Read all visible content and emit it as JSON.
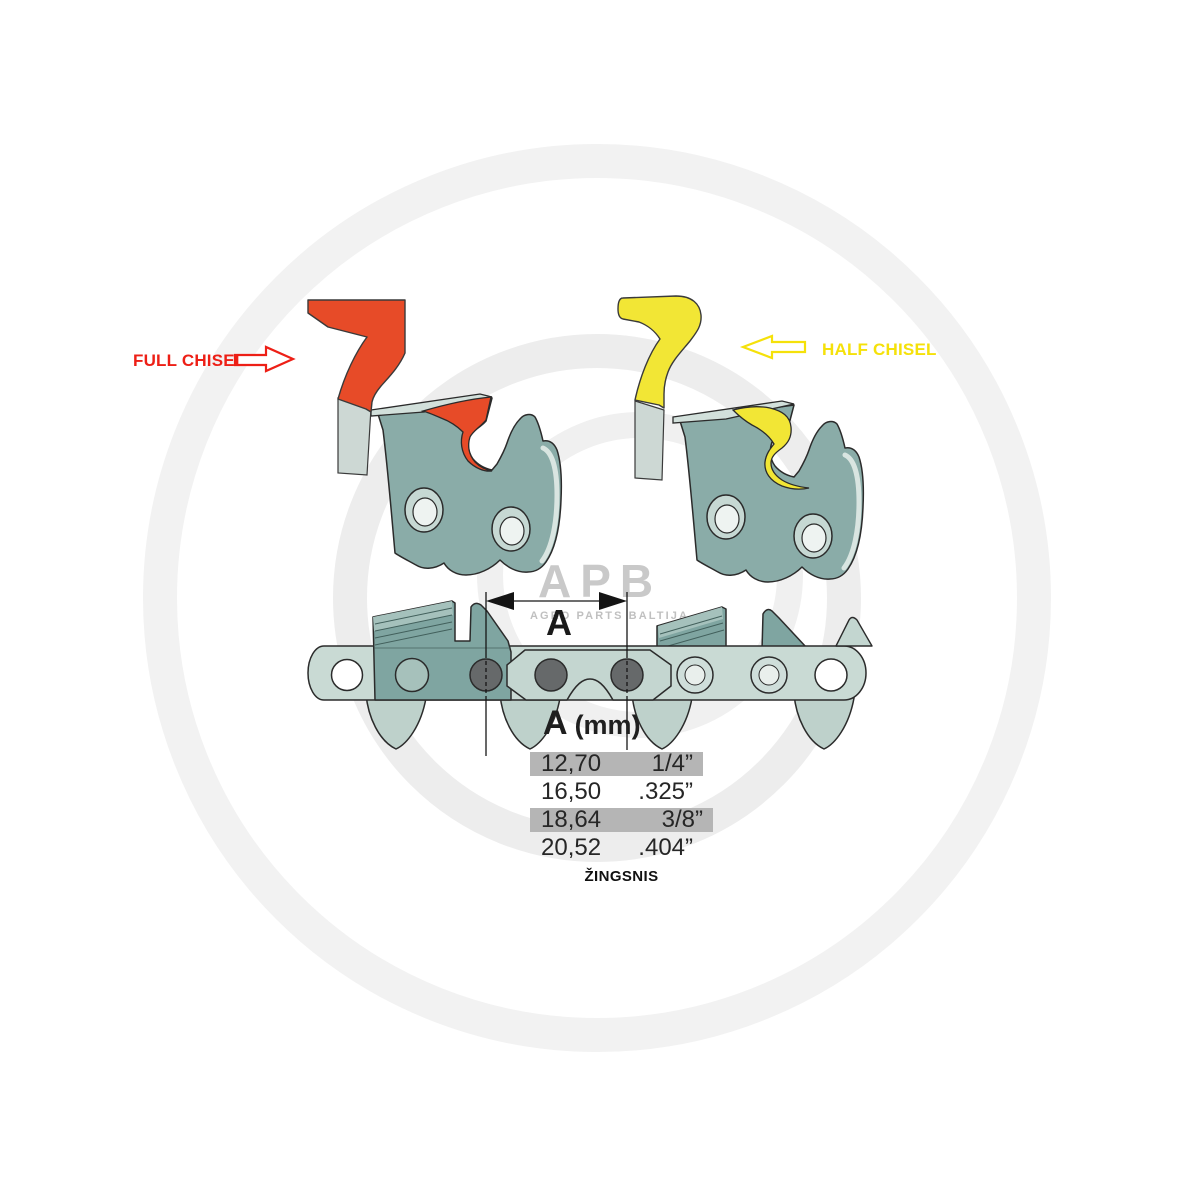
{
  "annotations": {
    "full_chisel": {
      "label": "FULL CHISEL",
      "color": "#ed1f16",
      "arrow_direction": "right"
    },
    "half_chisel": {
      "label": "HALF CHISEL",
      "color": "#f5e10a",
      "arrow_direction": "left"
    },
    "pitch_dimension_label": "A"
  },
  "watermark": {
    "logo": "APB",
    "subtitle": "AGRO PARTS BALTIJA"
  },
  "pitch_table": {
    "header": {
      "symbol": "A",
      "unit": "(mm)"
    },
    "rows": [
      {
        "mm": "12,70",
        "inch": "1/4”",
        "highlighted": true
      },
      {
        "mm": "16,50",
        "inch": ".325”",
        "highlighted": false
      },
      {
        "mm": "18,64",
        "inch": "3/8”",
        "highlighted": true
      },
      {
        "mm": "20,52",
        "inch": ".404”",
        "highlighted": false
      }
    ],
    "caption": "ŽINGSNIS",
    "row_highlight_color": "#b5b5b5"
  },
  "palette": {
    "full_chisel_red": "#e74b28",
    "half_chisel_yellow": "#f2e635",
    "chain_steel_light": "#c9dad4",
    "cutter_teal_dark": "#7fa5a1",
    "rivet_gray": "#66696a"
  }
}
